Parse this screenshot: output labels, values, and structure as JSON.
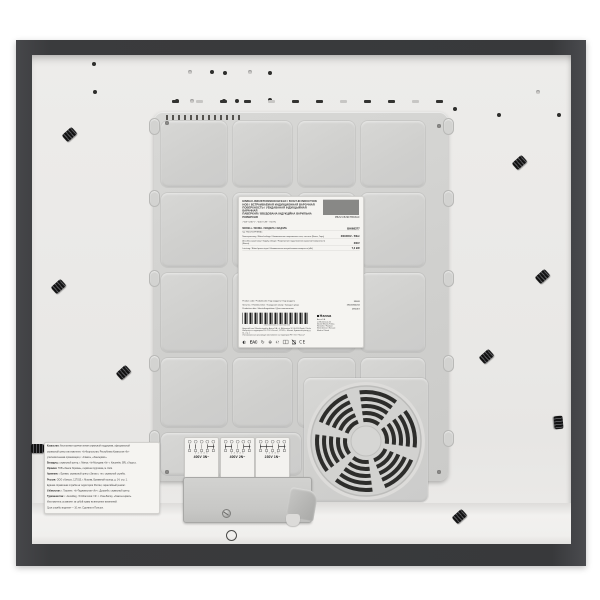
{
  "meta": {
    "subject": "underside of a built-in induction hob (product photo)",
    "brand": "Hansa"
  },
  "colors": {
    "background": "#ffffff",
    "frame_dark": "#3a3b3d",
    "base_panel": "#eae9e7",
    "cover_plastic": "#d2d2d0",
    "label_paper": "#f5f4f1",
    "fan_slot": "#2d2d2b"
  },
  "main_label": {
    "title_lines": [
      "EINBAU-INDUKTIONSKOCHFELD / BUILT-IN INDUCTION",
      "HOB / ВСТРАИВАЕМАЯ ИНДУКЦИОННАЯ ВАРОЧНАЯ",
      "ПОВЕРХНОСТЬ / УБУДАВАНАЯ ІНДУКЦЫЙНАЯ ВАРАЧНАЯ",
      "ПАВЕРХНЯ / ВБУДОВАНА ІНДУКЦІЙНА ВАРИЛЬНА",
      "ПОВЕРХНЯ"
    ],
    "specs_line": "7 kW  /  230 V~  /  400 V 2N~  /  50 Hz",
    "top_code": "PBZxVI529FTB93AC",
    "model_row": {
      "label": "MODELL / MODEL / МОДЕЛЬ / МАДЭЛЬ",
      "value": "BHI68377"
    },
    "type_row": "Typ: PBZxVI529FTB93AC",
    "spec_rows": [
      {
        "label": "Nennspannung / Rated voltage / Номинальное напряжение сети, частота (Вольт, Герц)",
        "value": "230/400V~ 50Hz"
      },
      {
        "label": "Anschlussspannung / Supply voltage / Напряжение подключения варочной поверхности (Вольт)",
        "value": "230V"
      },
      {
        "label": "Leistung / Rated power input / Номинальная потребляемая мощность (кВт)",
        "value": "7,2 kW"
      }
    ],
    "product_rows": [
      {
        "label": "Product code / Produktcode / Код продукта / Код прадукта",
        "value": "33609"
      },
      {
        "label": "Serial no. / Fabriknummer / Заводской номер / Заводскі нумар",
        "value": "19200360234"
      },
      {
        "label": "Production date / Herstellungsdatum / Дата изготовления",
        "value": "09/2019"
      }
    ],
    "barcode_number": "19200360234 000000000",
    "importer_lines": [
      "Hergestellt von / Manufactured by: Amica S.A., ul. Mickiewicza 52, 64-510 Wronki, Polska",
      "Импортёр на территорию РФ: ООО «Ханса», 127015, г. Москва, Бумажный проезд, д. 14, стр. 1",
      "Уполномоченная организация изготовителя на территории РФ: ООО «Ханса»"
    ],
    "brand_block": {
      "name": "Hansa",
      "lines": [
        "Amica S.A.",
        "ul. Mickiewicza 52",
        "64-510 Wronki, Polska",
        "Hersteller / Producer",
        "Изготовлено в Польше",
        "Made in Poland"
      ]
    },
    "icons": [
      {
        "name": "rostest-icon",
        "type": "glyph",
        "value": "◐"
      },
      {
        "name": "eac-mark",
        "type": "eac",
        "value": "EAC"
      },
      {
        "name": "recycle-icon",
        "type": "glyph",
        "value": "↻"
      },
      {
        "name": "cert-circle-icon",
        "type": "glyph",
        "value": "⊕"
      },
      {
        "name": "estimated-sign-icon",
        "type": "glyph",
        "value": "℮"
      },
      {
        "name": "manual-book-icon",
        "type": "book",
        "value": ""
      },
      {
        "name": "weee-crossed-bin-icon",
        "type": "bin",
        "value": ""
      },
      {
        "name": "ce-mark",
        "type": "ce",
        "value": "CE"
      }
    ]
  },
  "wiring_labels": [
    {
      "voltage": "400V 3N~",
      "terminals": "1 2 3 4 5",
      "bridges": [
        [
          3,
          4
        ]
      ]
    },
    {
      "voltage": "400V 2N~",
      "terminals": "1 2 3 4 5",
      "bridges": [
        [
          0,
          1
        ],
        [
          3,
          4
        ]
      ]
    },
    {
      "voltage": "230V 1N~",
      "terminals": "1 2 3 4 5",
      "bridges": [
        [
          0,
          2
        ],
        [
          3,
          4
        ]
      ]
    }
  ],
  "service_label": {
    "lines": [
      "<b>Казахстан:</b> бесплатная горячая линия сервисной поддержки, официальный",
      "сервисный центр изготовителя. <b>Кыргызстан, Республика Казахстан:</b>",
      "уполномоченная организация, г. Алматы, «Хансервис».",
      "<b>Беларусь:</b> сервисный центр, г. Минск; <b>Молдова:</b> г. Кишинёв, SRL «Хорус».",
      "<b>Украина:</b> ТОВ «Ханса Україна», сервісна підтримка, м. Київ.",
      "<b>Армения:</b> г. Ереван, сервисный центр «Зигзаг»; тел. сервисной службы.",
      "<b>Россия:</b> ООО «Ханса», 127015, г. Москва, Бумажный проезд, д. 14, стр. 1.",
      "Единая справочная служба на территории России, гарантийный ремонт.",
      "<b>Узбекистан:</b> г. Ташкент; <b>Таджикистан:</b> г. Душанбе, сервисный центр.",
      "<b>Туркменистан:</b> г. Ашхабад; <b>Монголия:</b> г. Улан-Батор, «Ханса-сервис».",
      "Изготовитель оставляет за собой право на внесение изменений.",
      "Срок службы изделия — 10 лет. Сделано в Польше."
    ]
  },
  "features": {
    "holes_dark": [
      [
        92,
        62
      ],
      [
        93,
        90
      ],
      [
        210,
        70
      ],
      [
        223,
        71
      ],
      [
        268,
        71
      ],
      [
        175,
        99
      ],
      [
        222,
        99
      ],
      [
        235,
        99
      ],
      [
        268,
        98
      ],
      [
        497,
        113
      ],
      [
        557,
        113
      ],
      [
        443,
        125
      ],
      [
        453,
        107
      ]
    ],
    "holes_light": [
      [
        188,
        70
      ],
      [
        190,
        99
      ],
      [
        248,
        70
      ],
      [
        536,
        90
      ]
    ],
    "clips": [
      [
        63,
        130,
        -42
      ],
      [
        513,
        158,
        -42
      ],
      [
        536,
        272,
        -42
      ],
      [
        52,
        282,
        -42
      ],
      [
        117,
        368,
        -42
      ],
      [
        480,
        352,
        -42
      ],
      [
        552,
        418,
        85
      ],
      [
        453,
        512,
        -42
      ],
      [
        31,
        444,
        0
      ]
    ],
    "dash_row": {
      "y": 100,
      "x_start": 172,
      "step": 24,
      "count": 12
    },
    "grid_cols": [
      4,
      76,
      141,
      204,
      274,
      292
    ],
    "grid_rows": [
      6,
      78,
      158,
      243,
      318
    ],
    "tabs_y": [
      118,
      190,
      270,
      355,
      430
    ],
    "serration": {
      "x_start": 166,
      "y": 115,
      "step": 6,
      "count": 13
    },
    "cover_screws": [
      [
        165,
        121
      ],
      [
        437,
        124
      ],
      [
        165,
        470
      ],
      [
        437,
        470
      ]
    ],
    "fan": {
      "cx": 365,
      "cy": 440,
      "radii": [
        21,
        28,
        35,
        42,
        49
      ],
      "gap_angles": [
        -75,
        -15,
        45,
        105,
        165,
        225
      ],
      "gap_width": 15
    },
    "stamps": [
      [
        226,
        530
      ]
    ]
  }
}
